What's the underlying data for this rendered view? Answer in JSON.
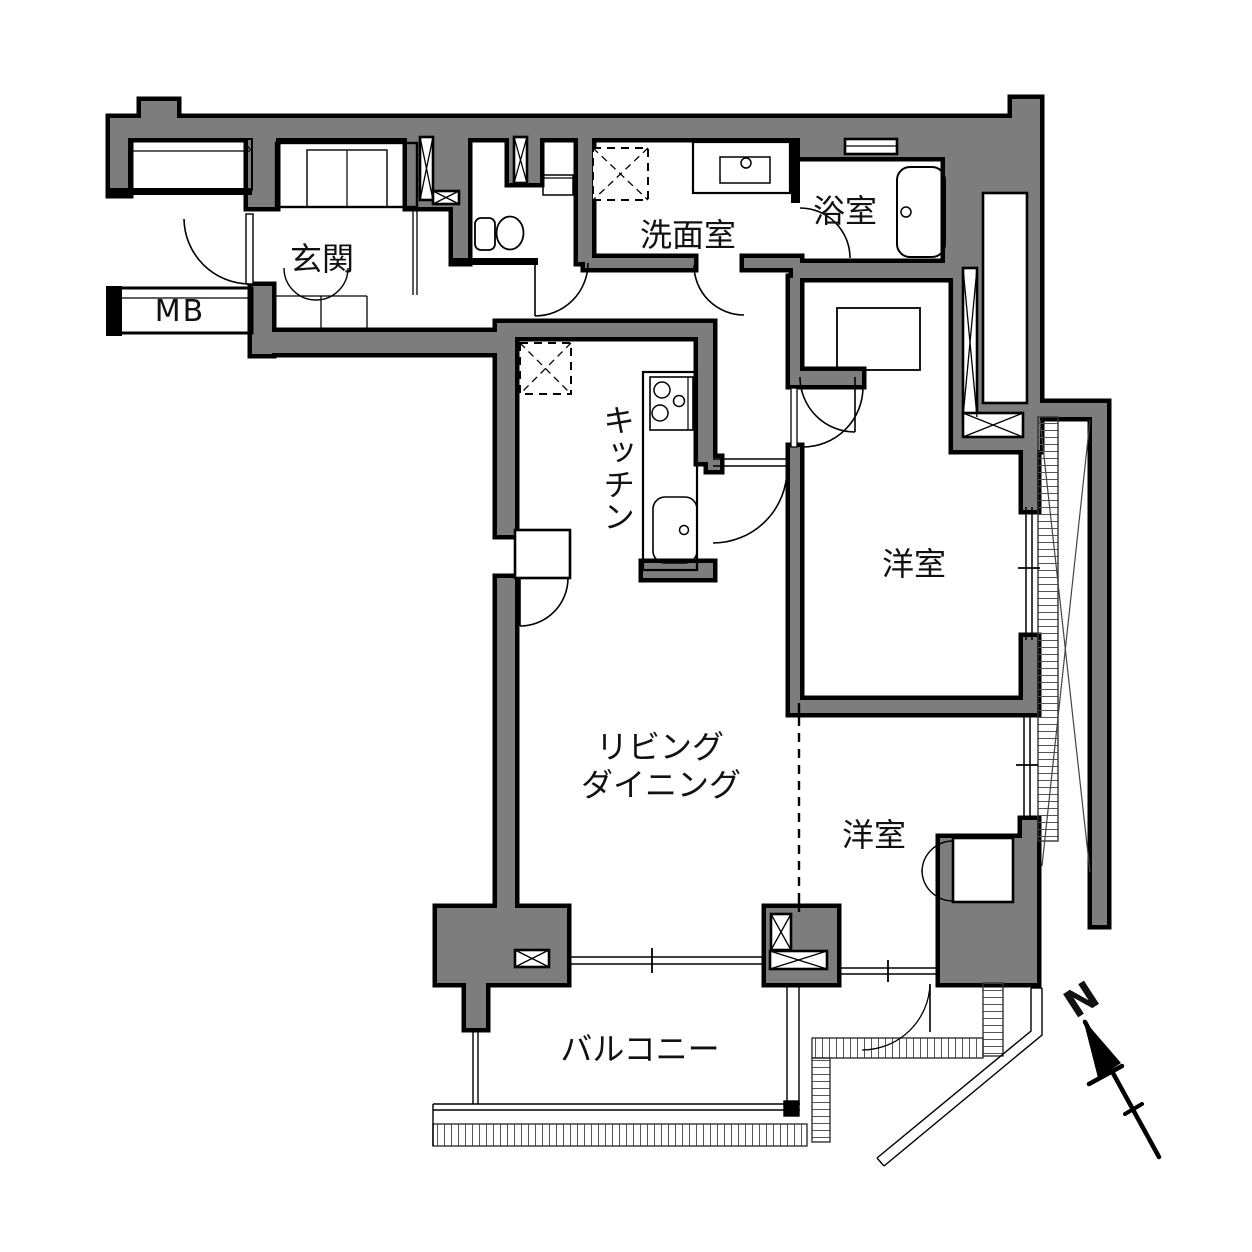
{
  "colors": {
    "wall_fill": "#7d7d7d",
    "outline": "#000000",
    "hatch": "#555555",
    "text": "#111111",
    "background": "#ffffff"
  },
  "rooms": {
    "entrance": "玄関",
    "meter_box": "MB",
    "washroom": "洗面室",
    "bathroom": "浴室",
    "kitchen": "キッチン",
    "living_dining_line1": "リビング",
    "living_dining_line2": "ダイニング",
    "bedroom_east": "洋室",
    "bedroom_south": "洋室",
    "balcony": "バルコニー"
  },
  "compass": {
    "north_label": "N"
  }
}
